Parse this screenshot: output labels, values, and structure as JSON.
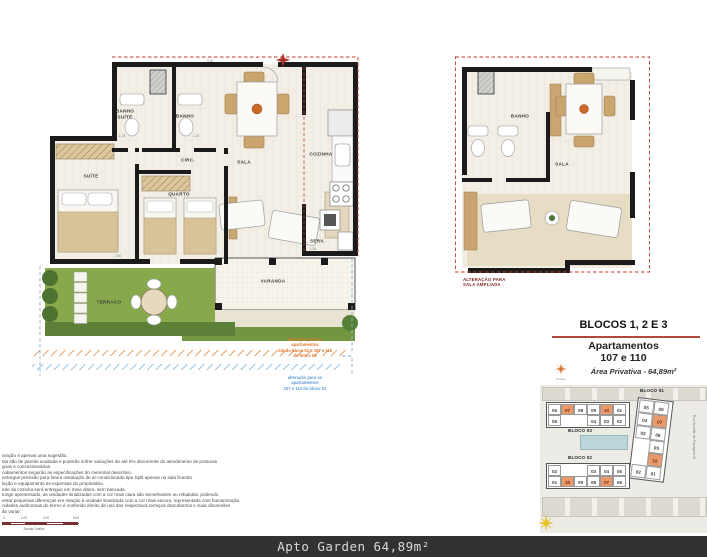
{
  "main_plan": {
    "rooms": {
      "banho_suite": "BANHO\nSUÍTE",
      "banho": "BANHO",
      "circ": "CIRC.",
      "sala": "SALA",
      "cozinha": "COZINHA",
      "suite": "SUÍTE",
      "quarto": "QUARTO",
      "a_serv": "A. SERV.",
      "varanda": "VARANDA",
      "terraco": "TERRAÇO"
    },
    "dims": {
      "d1": "1.28",
      "d2": "1.28",
      "d3": "3.10",
      "d4": "2.80",
      "d5": "1.38"
    },
    "annotation_orange": "alteração para os apartamentos\n110 do bloco 02 e 107 e 110 do bloco 03",
    "annotation_blue": "alteração para os apartamentos\n107 e 110 do bloco 01"
  },
  "right_plan": {
    "rooms": {
      "banho": "BANHO",
      "sala": "SALA"
    },
    "note": "ALTERAÇÃO PARA\nSALA AMPLIADA"
  },
  "info": {
    "title": "BLOCOS 1, 2 E 3",
    "subtitle_line1": "Apartamentos",
    "subtitle_line2": "107 e 110",
    "area": "Área Privativa - 64,89m²",
    "compass_label": "Poente"
  },
  "sitemap": {
    "street": "Rua Servidão de Passagem 01",
    "bloco03": {
      "label": "BLOCO 03",
      "row1": [
        {
          "n": "06"
        },
        {
          "n": "07",
          "hl": "true"
        },
        {
          "n": "08"
        },
        {
          "n": "09"
        },
        {
          "n": "10",
          "hl": "true"
        },
        {
          "n": "01"
        }
      ],
      "row2": [
        {
          "n": "05"
        },
        {
          "n": "04"
        },
        {
          "n": "03"
        },
        {
          "n": "02"
        }
      ]
    },
    "bloco02": {
      "label": "BLOCO 02",
      "row1": [
        {
          "n": "02"
        },
        {
          "n": "03"
        },
        {
          "n": "04"
        },
        {
          "n": "05"
        }
      ],
      "row2": [
        {
          "n": "01"
        },
        {
          "n": "10",
          "hl": "true"
        },
        {
          "n": "09"
        },
        {
          "n": "08"
        },
        {
          "n": "07",
          "hl": "true"
        },
        {
          "n": "06"
        }
      ]
    },
    "bloco01": {
      "label": "BLOCO 01",
      "rows": [
        {
          "a": "05",
          "b": "06"
        },
        {
          "a": "04",
          "b": "07",
          "bhl": "true"
        },
        {
          "a": "03",
          "b": "08"
        },
        {
          "b": "09"
        },
        {
          "b": "10",
          "bhl": "true"
        },
        {
          "a": "02",
          "b": "01"
        }
      ]
    }
  },
  "disclaimer": {
    "lines": [
      "oração é apenas uma sugestão.",
      "tas são de parede acabada e poderão sofrer variações de até 5% decorrente do atendimento de posturas",
      "guas e concessionárias.",
      "cabamentos seguirão as especificações do memorial descritivo.",
      "entregue previsão para futura instalação de ar-condicionado tipo Split apenas na sala ficando",
      "lação e equipamento às expensas do proprietário.",
      "ede da cozinha será entregue em meia altura, sem bancada.",
      "tunge apresentado, as unidades sinalizadas com a cor mais clara são semelhantes ou rebatidas, podendo",
      "entar pequenas diferenças em relação à unidade sinalizada com a cor mais escura, representada com humanização.",
      "nidades autônomas do térreo é conferido direito de uso dos respectivos terraços descobertos e suas dimensões",
      "ão variar."
    ]
  },
  "scalebar": {
    "l0": "0",
    "l1": "1.00",
    "l2": "2.00",
    "l3": "5.00",
    "caption": "Escala Gráfica"
  },
  "footer": {
    "label": "Apto Garden 64,89m²"
  }
}
